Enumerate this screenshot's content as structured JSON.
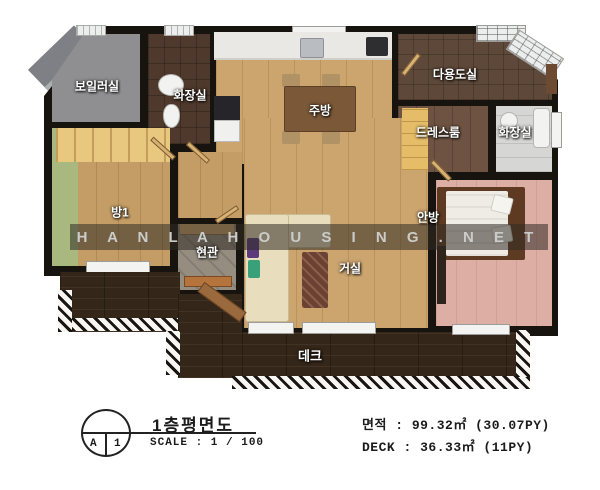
{
  "plan": {
    "rooms": {
      "boiler": {
        "label": "보일러실"
      },
      "bath1": {
        "label": "화장실"
      },
      "kitchen": {
        "label": "주방"
      },
      "utility": {
        "label": "다용도실"
      },
      "dressroom": {
        "label": "드레스룸"
      },
      "bath2": {
        "label": "화장실"
      },
      "room1": {
        "label": "방1"
      },
      "entrance": {
        "label": "현관"
      },
      "living": {
        "label": "거실"
      },
      "master": {
        "label": "안방"
      },
      "deck": {
        "label": "데크"
      }
    },
    "watermark": "H A N L A H O U S I N G . N E T"
  },
  "title_block": {
    "sheet_letter": "A",
    "sheet_number": "1",
    "title": "1층평면도",
    "scale": "SCALE :  1 / 100"
  },
  "area_block": {
    "floor_area": "면적 : 99.32㎡ (30.07PY)",
    "deck_area": "DECK : 36.33㎡ (11PY)"
  },
  "colors": {
    "wall": "#17130e",
    "wood_floor": "#cba46e",
    "deck_wood": "#342618",
    "master_floor": "#dcaea4",
    "boiler_floor": "#8f8f91",
    "watermark_band": "rgba(50,44,36,0.55)",
    "label_text": "#ffffff",
    "annotation_text": "#1b1b1b"
  }
}
